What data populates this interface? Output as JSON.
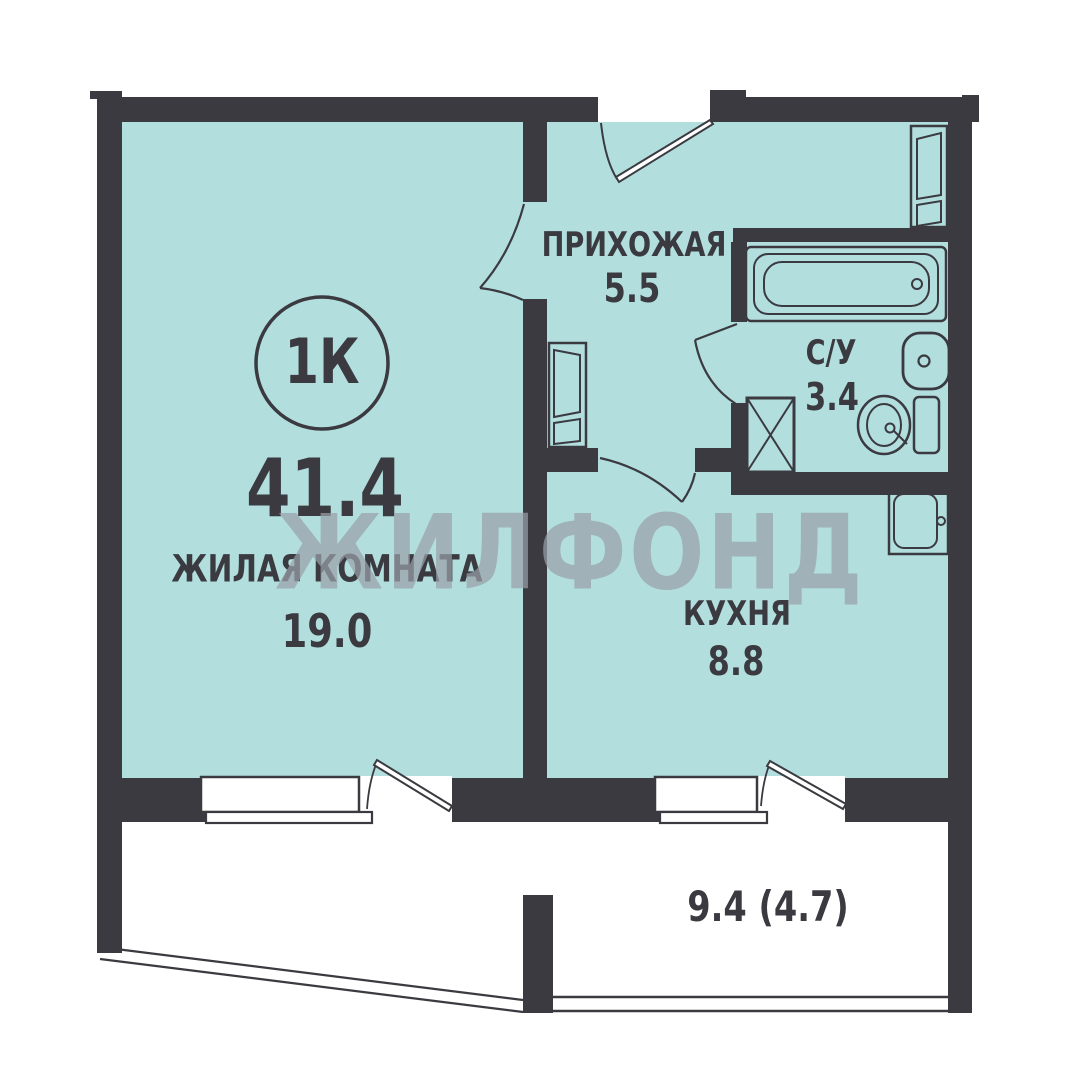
{
  "floorplan": {
    "badge": "1К",
    "total_area": "41.4",
    "watermark": "ЖИЛФОНД",
    "rooms": {
      "living": {
        "label": "ЖИЛАЯ КОМНАТА",
        "area": "19.0"
      },
      "hallway": {
        "label": "ПРИХОЖАЯ",
        "area": "5.5"
      },
      "bathroom": {
        "label": "С/У",
        "area": "3.4"
      },
      "kitchen": {
        "label": "КУХНЯ",
        "area": "8.8"
      },
      "balcony": {
        "area": "9.4 (4.7)"
      }
    },
    "symbols": [
      "bathtub",
      "bathroom-sink",
      "toilet",
      "ventilation-shaft",
      "kitchen-sink",
      "wardrobe",
      "hall-cabinet"
    ],
    "colors": {
      "wall": "#3a3a40",
      "floor": "#b2dfde",
      "fixture_outline": "#3a3a40",
      "watermark": "#989fa7",
      "window_fill": "#ffffff",
      "text": "#3a3a40",
      "background": "#ffffff"
    }
  }
}
